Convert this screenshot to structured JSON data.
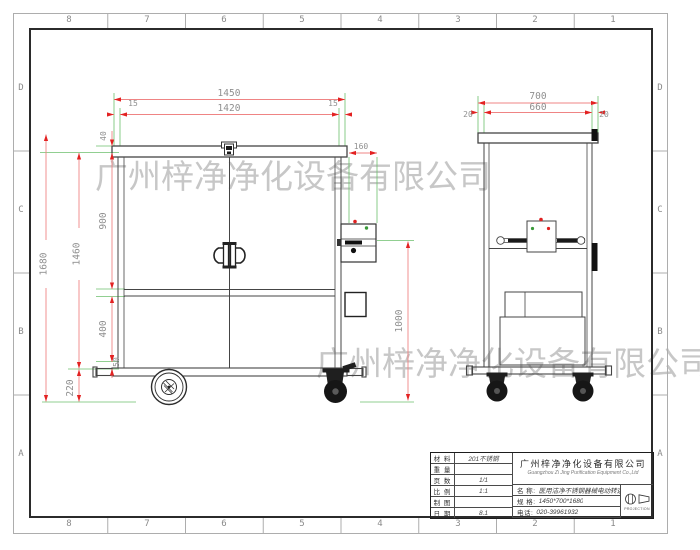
{
  "watermark": {
    "text": "广州梓净净化设备有限公司",
    "color": "#c7c7c7"
  },
  "border": {
    "top_zones": [
      "8",
      "7",
      "6",
      "5",
      "4",
      "3",
      "2",
      "1"
    ],
    "bottom_zones": [
      "8",
      "7",
      "6",
      "5",
      "4",
      "3",
      "2",
      "1"
    ],
    "left_zones": [
      "D",
      "C",
      "B",
      "A"
    ],
    "right_zones": [
      "D",
      "C",
      "B",
      "A"
    ]
  },
  "front_view": {
    "dims": {
      "total_width": "1450",
      "inner_width": "1420",
      "edge_left": "15",
      "edge_right": "15",
      "cap_height": "40",
      "upper_section": "900",
      "door_region": "1460",
      "total_height": "1680",
      "lower_section": "400",
      "base_gap": "50",
      "caster_height": "220",
      "side_box_width": "160",
      "side_height": "1000"
    }
  },
  "side_view": {
    "dims": {
      "total_depth": "700",
      "inner_depth": "660",
      "edge_front": "20",
      "edge_back": "20"
    }
  },
  "title_block": {
    "rows": [
      {
        "label": "材 料",
        "value": "201不锈钢"
      },
      {
        "label": "重 量",
        "value": ""
      },
      {
        "label": "页 数",
        "value": "1/1"
      },
      {
        "label": "比 例",
        "value": "1:1"
      },
      {
        "label": "制 图",
        "value": ""
      },
      {
        "label": "日 期",
        "value": "8.1"
      }
    ],
    "company_cn": "广州梓净净化设备有限公司",
    "company_en": "Guangzhou Zi Jing Purification Equipment Co.,Ltd",
    "name_label": "名  称:",
    "name_value": "医用洁净不锈钢器械电动转运车",
    "spec_label": "规  格:",
    "spec_value": "1450*700*1680",
    "phone_label": "电话:",
    "phone_value": "020-39961932",
    "projection_label": "PROJECTION"
  },
  "colors": {
    "dim_line": "#ef8484",
    "dim_arrow": "#e32222",
    "extension_line": "#6dbf6d",
    "dim_text": "#8f8f8f",
    "drawing_line": "#454545",
    "watermark": "#c7c7c7",
    "indicator_red": "#e02020",
    "indicator_green": "#3a9a3a"
  }
}
